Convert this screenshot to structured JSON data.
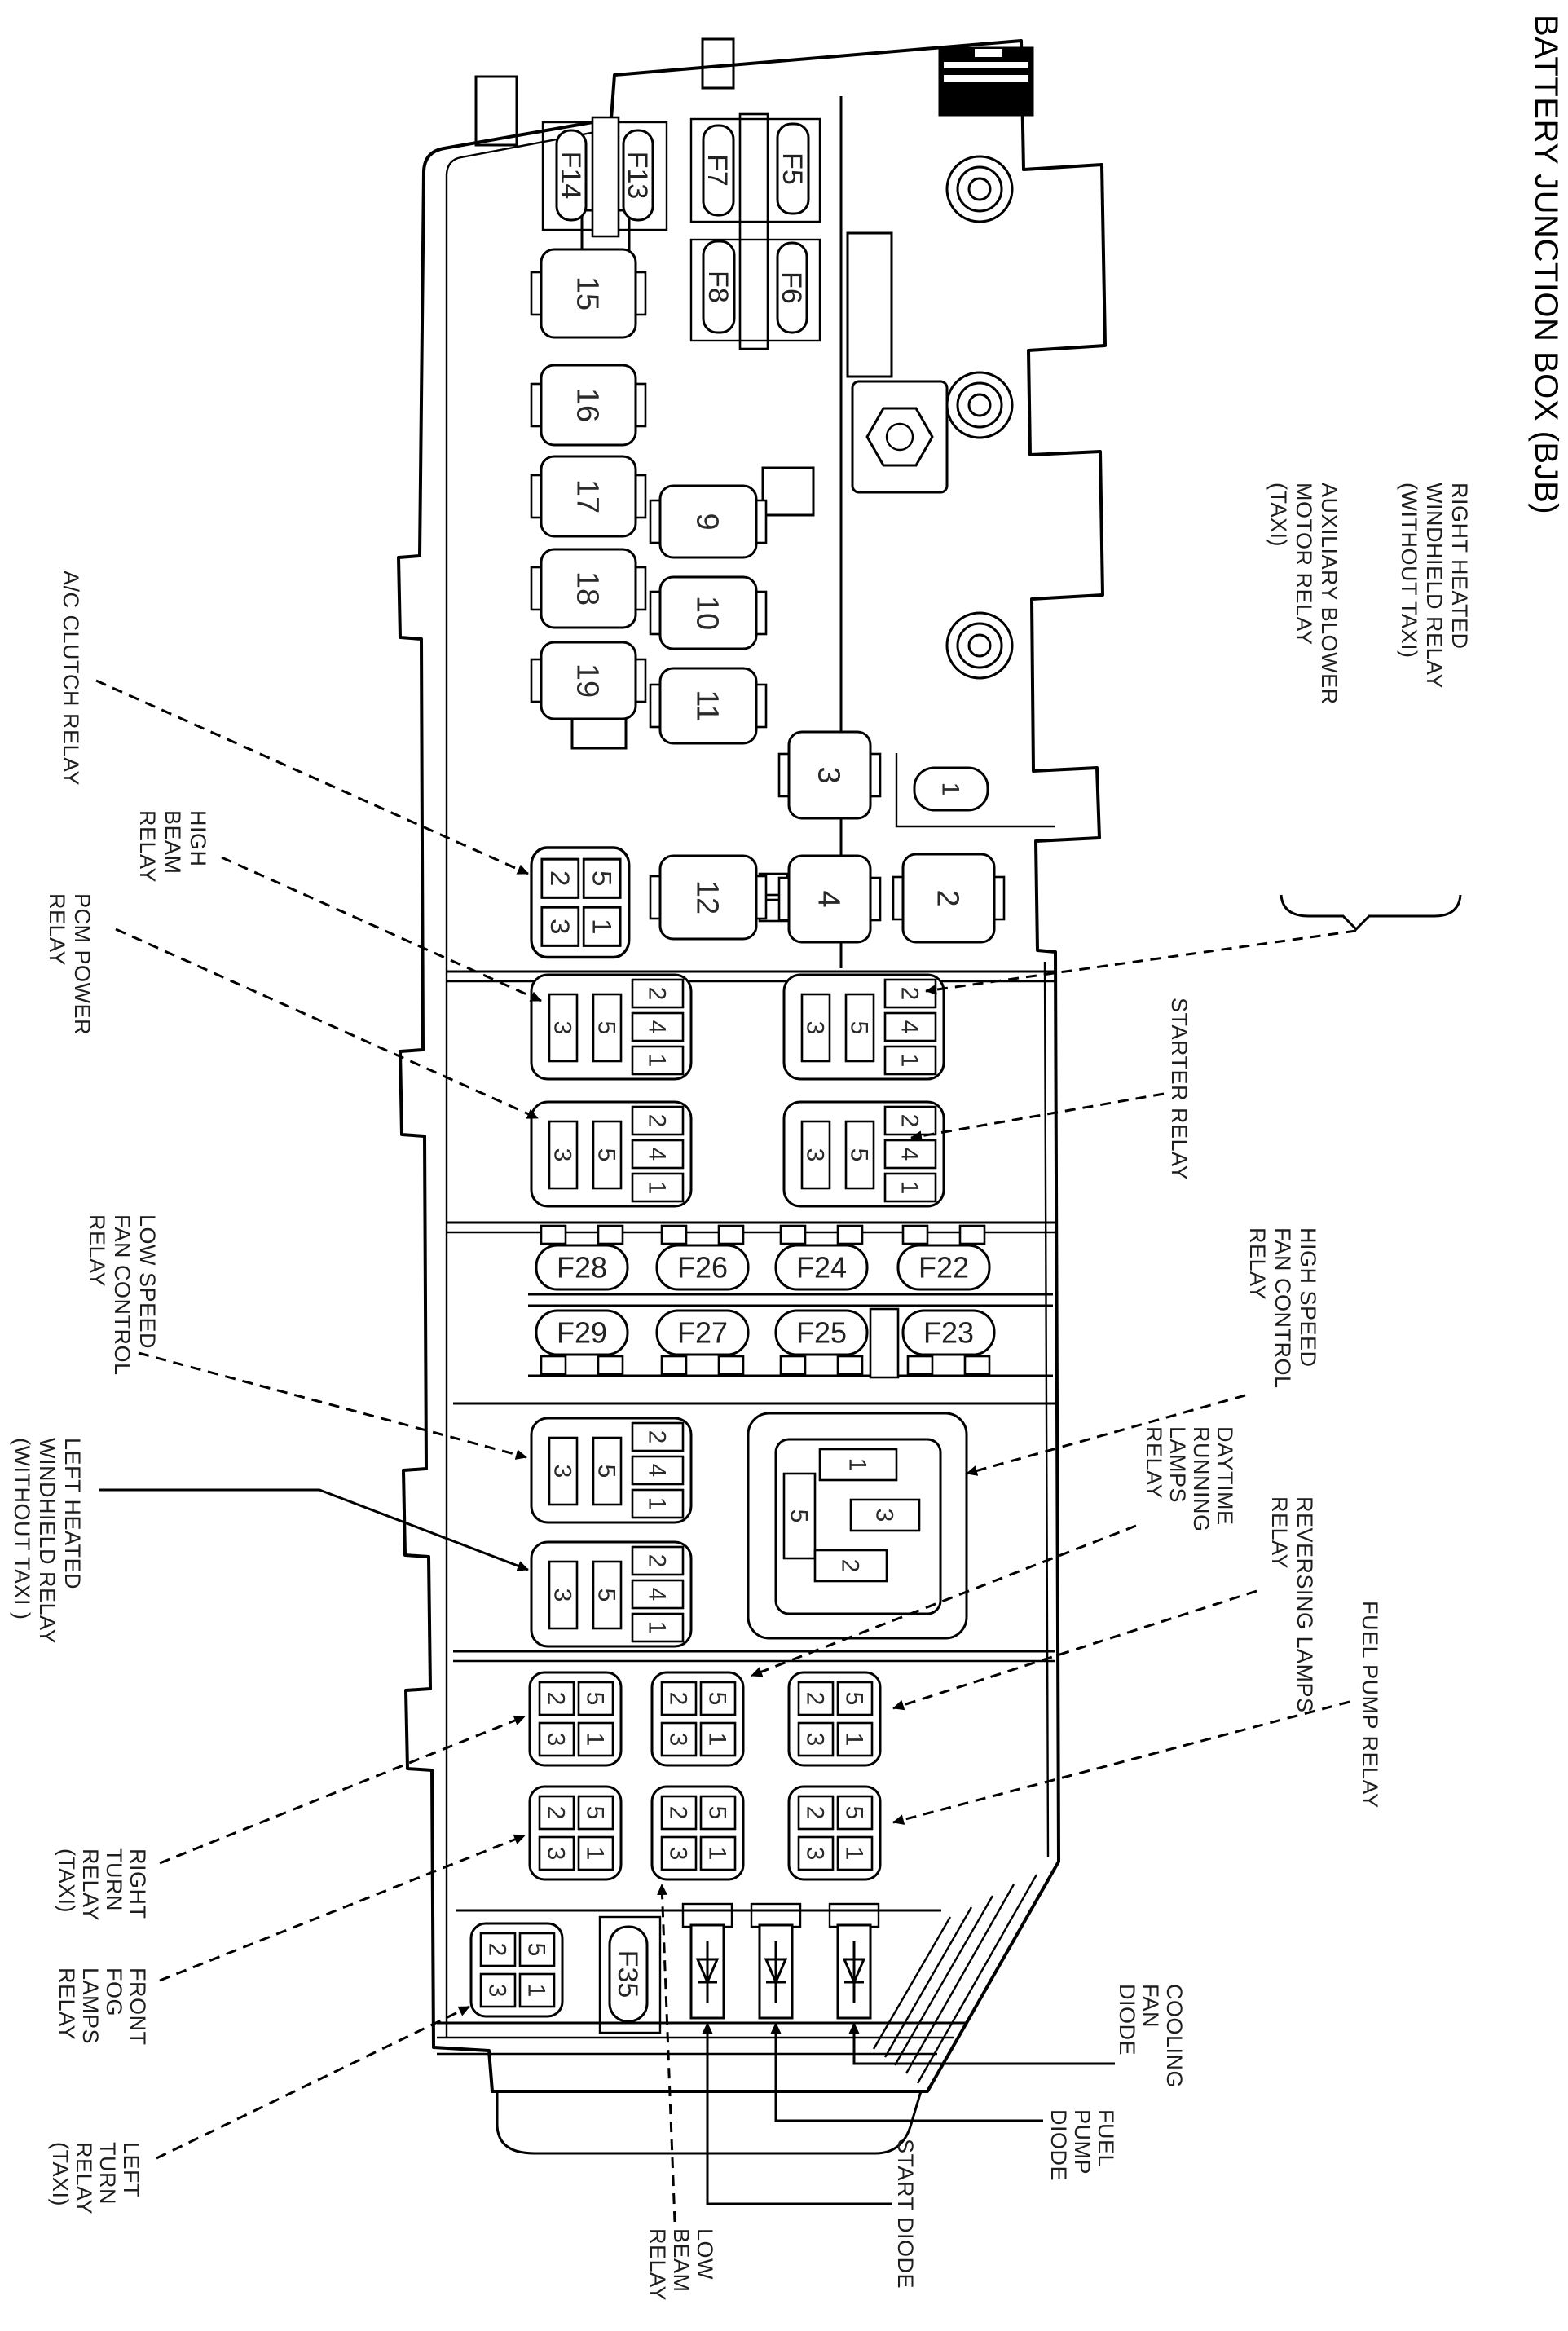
{
  "title": "BATTERY JUNCTION BOX (BJB)",
  "pins": {
    "p1": "1",
    "p2": "2",
    "p3": "3",
    "p4": "4",
    "p5": "5"
  },
  "relays": {
    "r1": "1",
    "r2": "2",
    "r3": "3",
    "r4": "4",
    "r9": "9",
    "r10": "10",
    "r11": "11",
    "r12": "12",
    "r15": "15",
    "r16": "16",
    "r17": "17",
    "r18": "18",
    "r19": "19"
  },
  "fuses": {
    "f14": "F14",
    "f13": "F13",
    "f7": "F7",
    "f5": "F5",
    "f8": "F8",
    "f6": "F6",
    "f28": "F28",
    "f26": "F26",
    "f24": "F24",
    "f22": "F22",
    "f29": "F29",
    "f27": "F27",
    "f25": "F25",
    "f23": "F23",
    "f35": "F35"
  },
  "callouts": {
    "ac_clutch": {
      "lines": [
        "A/C CLUTCH RELAY"
      ]
    },
    "high_beam": {
      "lines": [
        "HIGH",
        "BEAM",
        "RELAY"
      ]
    },
    "pcm_power": {
      "lines": [
        "PCM POWER",
        "RELAY"
      ]
    },
    "low_speed_fan": {
      "lines": [
        "LOW SPEED",
        "FAN CONTROL",
        "RELAY"
      ]
    },
    "left_heated": {
      "lines": [
        "LEFT HEATED",
        "WINDHIELD RELAY",
        "(WITHOUT TAXI )"
      ]
    },
    "right_turn": {
      "lines": [
        "RIGHT",
        "TURN",
        "RELAY",
        "(TAXI)"
      ]
    },
    "front_fog": {
      "lines": [
        "FRONT",
        "FOG",
        "LAMPS",
        "RELAY"
      ]
    },
    "left_turn": {
      "lines": [
        "LEFT",
        "TURN",
        "RELAY",
        "(TAXI)"
      ]
    },
    "low_beam": {
      "lines": [
        "LOW",
        "BEAM",
        "RELAY"
      ]
    },
    "start_diode": {
      "lines": [
        "START DIODE"
      ]
    },
    "fuel_pump_diode": {
      "lines": [
        "FUEL",
        "PUMP",
        "DIODE"
      ]
    },
    "cooling_fan_diode": {
      "lines": [
        "COOLING",
        "FAN",
        "DIODE"
      ]
    },
    "right_heated": {
      "lines": [
        "RIGHT HEATED",
        "WINDHIELD RELAY",
        "(WITHOUT TAXI)"
      ]
    },
    "aux_blower": {
      "lines": [
        "AUXILIARY BLOWER",
        "MOTOR RELAY",
        "(TAXI)"
      ]
    },
    "starter": {
      "lines": [
        "STARTER RELAY"
      ]
    },
    "high_speed_fan": {
      "lines": [
        "HIGH SPEED",
        "FAN CONTROL",
        "RELAY"
      ]
    },
    "daytime": {
      "lines": [
        "DAYTIME",
        "RUNNING",
        "LAMPS",
        "RELAY"
      ]
    },
    "reversing": {
      "lines": [
        "REVERSING LAMPS",
        "RELAY"
      ]
    },
    "fuel_pump_relay": {
      "lines": [
        "FUEL PUMP RELAY"
      ]
    }
  }
}
